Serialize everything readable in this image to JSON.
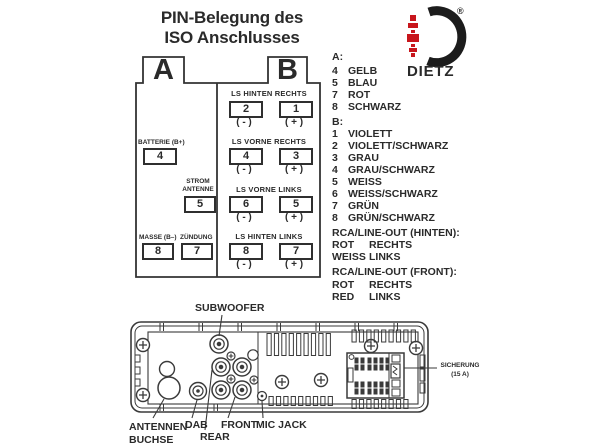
{
  "title": {
    "line1": "PIN-Belegung des",
    "line2": "ISO Anschlusses"
  },
  "logo": {
    "brand": "DIETZ",
    "registered": "®"
  },
  "colors": {
    "ink": "#2a2a2a",
    "line": "#3a3a3a",
    "red": "#c8161c"
  },
  "connector": {
    "tab_a": "A",
    "tab_b": "B",
    "side_a": {
      "battery_label": "BATTERIE (B+)",
      "battery_pin": "4",
      "strom_line1": "STROM",
      "strom_line2": "ANTENNE",
      "strom_pin": "5",
      "masse_label": "MASSE (B–)",
      "masse_pin": "8",
      "zuendung_label": "ZÜNDUNG",
      "zuendung_pin": "7"
    },
    "side_b": {
      "rows": [
        {
          "label": "LS HINTEN RECHTS",
          "left_pin": "2",
          "right_pin": "1",
          "left_sign": "( - )",
          "right_sign": "( + )"
        },
        {
          "label": "LS VORNE RECHTS",
          "left_pin": "4",
          "right_pin": "3",
          "left_sign": "( - )",
          "right_sign": "( + )"
        },
        {
          "label": "LS VORNE LINKS",
          "left_pin": "6",
          "right_pin": "5",
          "left_sign": "( - )",
          "right_sign": "( + )"
        },
        {
          "label": "LS HINTEN LINKS",
          "left_pin": "8",
          "right_pin": "7",
          "left_sign": "( - )",
          "right_sign": "( + )"
        }
      ]
    }
  },
  "legend": {
    "a_heading": "A:",
    "a_items": [
      {
        "pin": "4",
        "color": "GELB"
      },
      {
        "pin": "5",
        "color": "BLAU"
      },
      {
        "pin": "7",
        "color": "ROT"
      },
      {
        "pin": "8",
        "color": "SCHWARZ"
      }
    ],
    "b_heading": "B:",
    "b_items": [
      {
        "pin": "1",
        "color": "VIOLETT"
      },
      {
        "pin": "2",
        "color": "VIOLETT/SCHWARZ"
      },
      {
        "pin": "3",
        "color": "GRAU"
      },
      {
        "pin": "4",
        "color": "GRAU/SCHWARZ"
      },
      {
        "pin": "5",
        "color": "WEISS"
      },
      {
        "pin": "6",
        "color": "WEISS/SCHWARZ"
      },
      {
        "pin": "7",
        "color": "GRÜN"
      },
      {
        "pin": "8",
        "color": "GRÜN/SCHWARZ"
      }
    ],
    "rca_rear_heading": "RCA/LINE-OUT (HINTEN):",
    "rca_rear_rows": [
      {
        "color": "ROT",
        "side": "RECHTS"
      },
      {
        "color": "WEISS",
        "side": "LINKS"
      }
    ],
    "rca_front_heading": "RCA/LINE-OUT (FRONT):",
    "rca_front_rows": [
      {
        "color": "ROT",
        "side": "RECHTS"
      },
      {
        "color": "RED",
        "side": "LINKS"
      }
    ]
  },
  "rear_panel": {
    "subwoofer": "SUBWOOFER",
    "antenna_line1": "ANTENNEN-",
    "antenna_line2": "BUCHSE",
    "dab": "DAB",
    "rear": "REAR",
    "front": "FRONT",
    "mic": "MIC JACK",
    "fuse_line1": "SICHERUNG",
    "fuse_line2": "(15 A)"
  }
}
